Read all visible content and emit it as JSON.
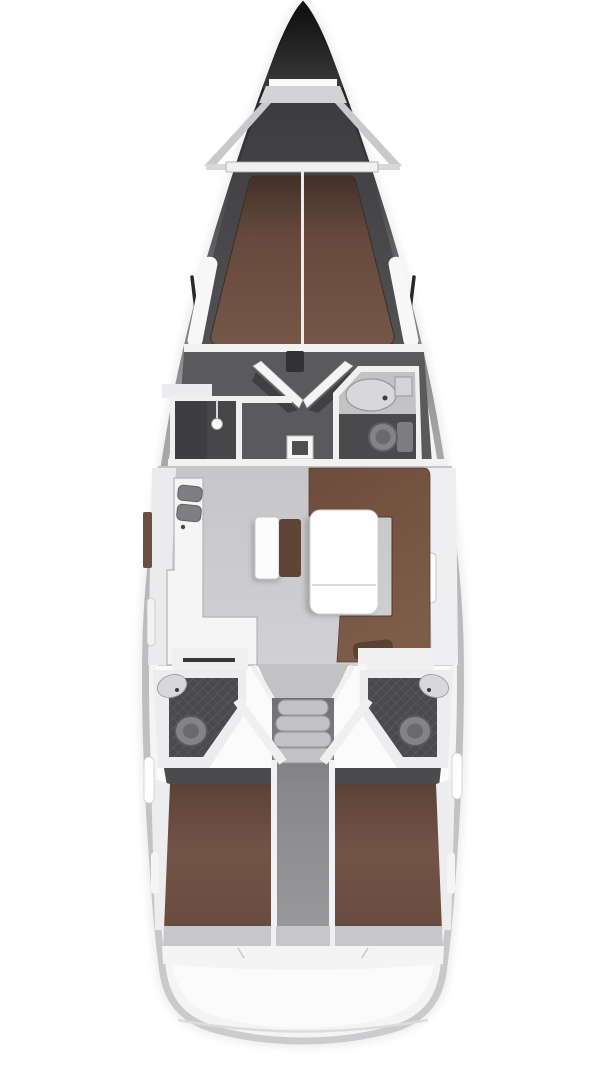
{
  "page": {
    "kind": "yacht-interior-floor-plan",
    "view": "top-down deck plan of a sailing yacht, bow at top, stern at bottom"
  },
  "canvas": {
    "width": 608,
    "height": 1080
  },
  "colors": {
    "background": "#ffffff",
    "bow_tip": "#161618",
    "deck_dark": "#47474a",
    "locker_gray": "#d3d3d5",
    "rail_gray": "#c9c9cb",
    "beam_white": "#f0f0f1",
    "liner_white": "#fbfbfc",
    "berth_brown": "#6e5143",
    "berth_centerline": "#ececed",
    "bulkhead_white": "#f2f2f3",
    "corridor_floor": "#5a5a5d",
    "door_white": "#f4f4f5",
    "door_shadow": "#3a3a3c",
    "entry_step": "#323235",
    "wardrobe_floor": "#47474a",
    "hanger_white": "#fdfdfe",
    "head_counter": "#c3c3c5",
    "sink_gray": "#d8d8da",
    "toilet_gray": "#848487",
    "toilet_inner": "#6a6a6d",
    "bath_floor": "#4a4a4d",
    "salon_floor": "#cbcbcd",
    "funnel_floor": "#c2c2c4",
    "galley_white": "#f5f5f6",
    "galley_sink": "#7f7f82",
    "window_brown": "#6b4f43",
    "window_white": "#fdfdfe",
    "sofa_brown": "#775743",
    "cushion_dark": "#5a4233",
    "table_white": "#fefefe",
    "bench_white": "#fcfcfd",
    "bench_cushion": "#5e4536",
    "shelf_white": "#f0f0f1",
    "towel_bar": "#38383a",
    "step_gray": "#c2c2c4",
    "wall_white": "#ededef",
    "cabin_shadow": "#4b4b4e",
    "floor_strip": "#c7c7c9",
    "transom_white": "#f4f4f5",
    "stern_line": "#dcdcdd",
    "chainplate": "#28282a"
  },
  "features": [
    {
      "name": "anchor-locker",
      "label": "Anchor locker"
    },
    {
      "name": "foredeck",
      "label": "Foredeck"
    },
    {
      "name": "forward-cabin",
      "label": "Forward V-berth cabin"
    },
    {
      "name": "wardrobe",
      "label": "Wardrobe locker"
    },
    {
      "name": "forward-head",
      "label": "Forward bathroom with sink and toilet"
    },
    {
      "name": "companionway-doors",
      "label": "Double cabin doors"
    },
    {
      "name": "saloon",
      "label": "Saloon"
    },
    {
      "name": "galley",
      "label": "L-shaped galley with twin sinks"
    },
    {
      "name": "dinette",
      "label": "U-shaped dinette sofa"
    },
    {
      "name": "saloon-table",
      "label": "Saloon table"
    },
    {
      "name": "saloon-bench",
      "label": "Mid-saloon bench seat"
    },
    {
      "name": "aft-head-port",
      "label": "Port aft bathroom"
    },
    {
      "name": "aft-head-starboard",
      "label": "Starboard aft bathroom"
    },
    {
      "name": "companionway-steps",
      "label": "Companionway steps"
    },
    {
      "name": "engine-compartment",
      "label": "Engine compartment between aft cabins"
    },
    {
      "name": "aft-cabin-port",
      "label": "Port aft double cabin"
    },
    {
      "name": "aft-cabin-starboard",
      "label": "Starboard aft double cabin"
    },
    {
      "name": "transom",
      "label": "Transom / stern"
    }
  ]
}
